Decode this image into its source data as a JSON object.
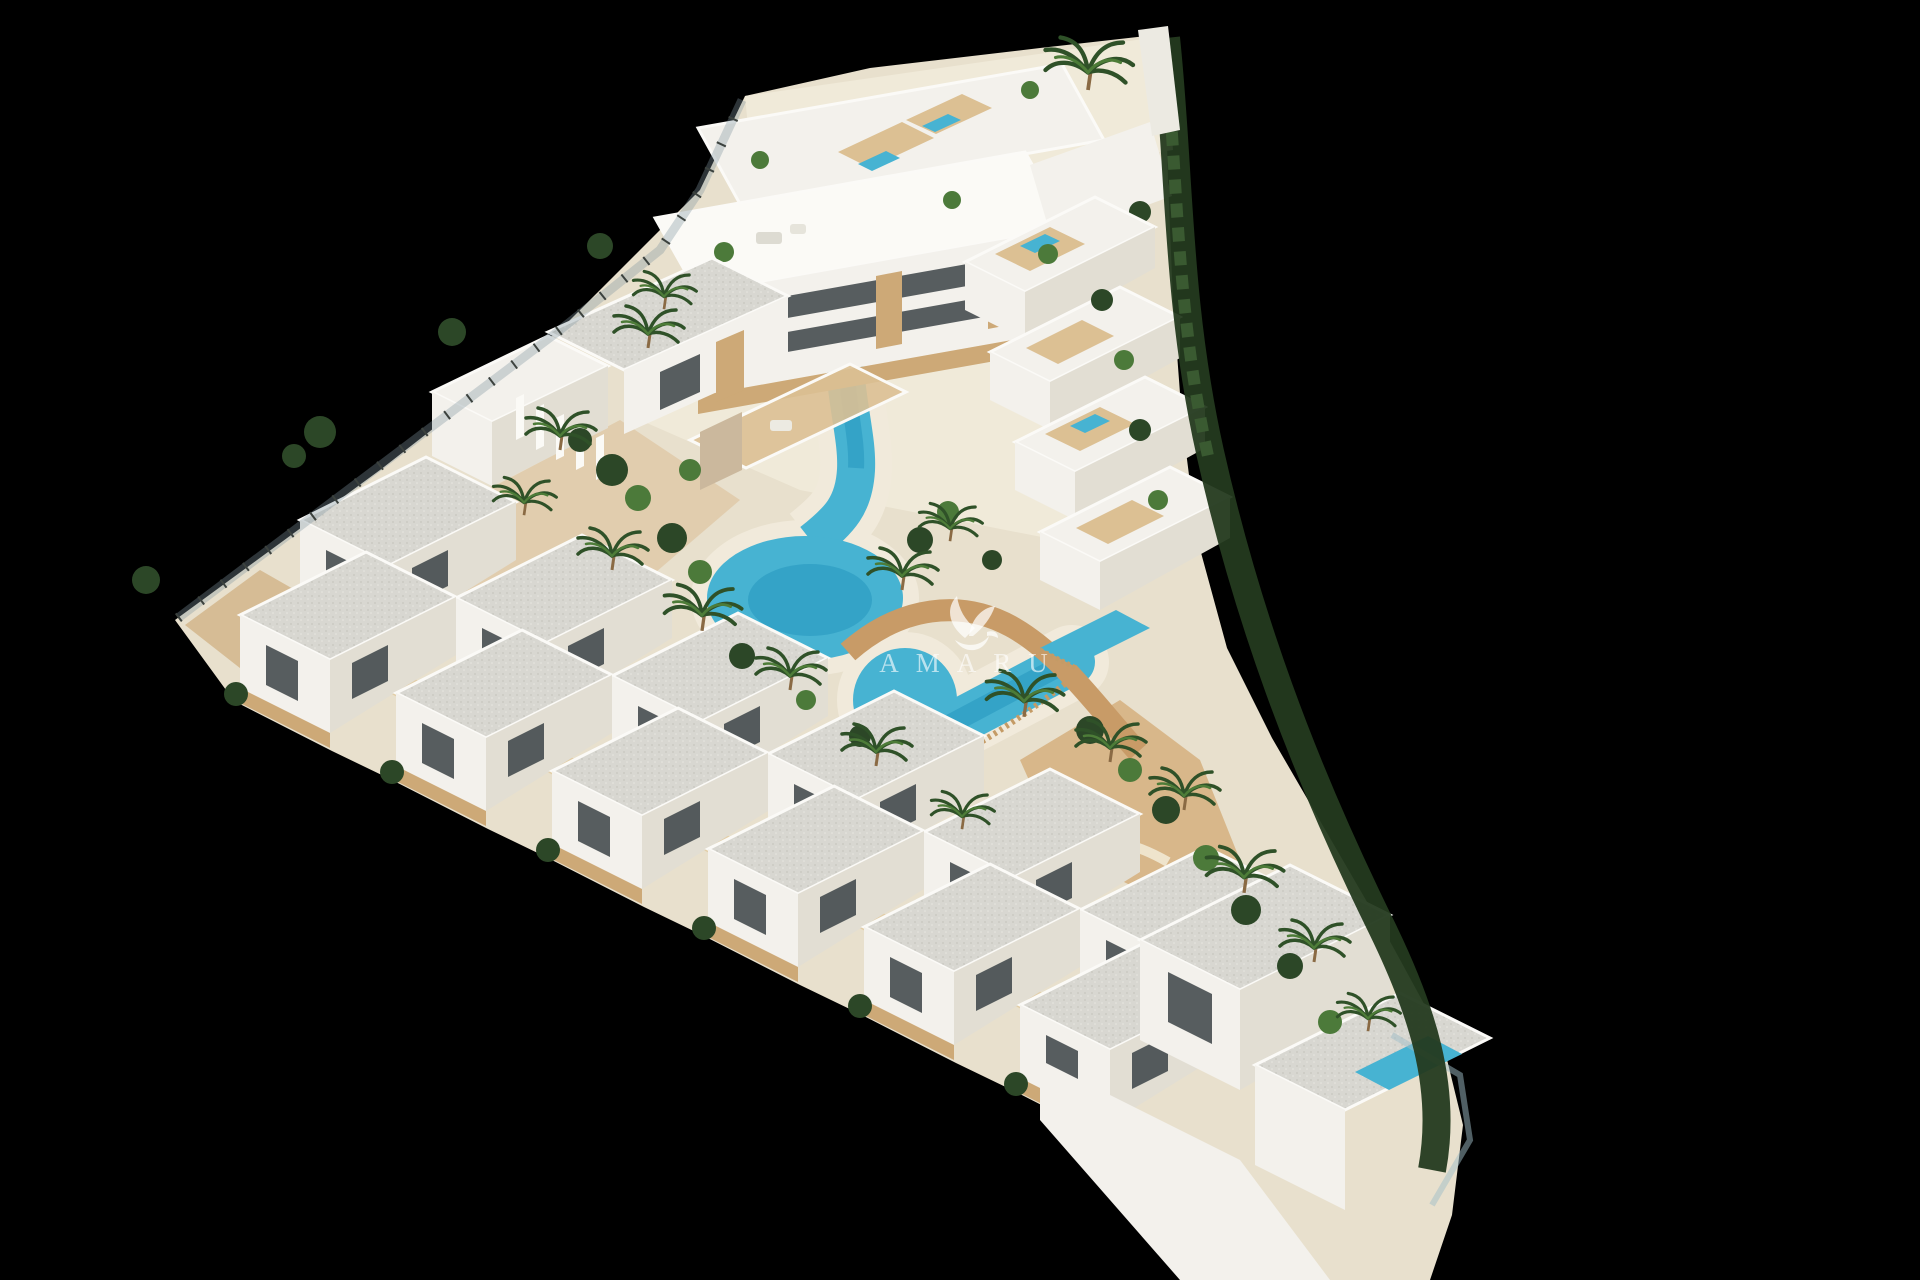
{
  "meta": {
    "scene": "aerial-3d-architectural-render",
    "background": "#000000"
  },
  "watermark": {
    "text": "AMARU",
    "icon": "hummingbird-leaf-icon"
  },
  "palette": {
    "bg": "#000000",
    "sand": "#e8e0cd",
    "sandLight": "#f0ead9",
    "beach": "#f1eadb",
    "pool": "#47b3d2",
    "poolDeep": "#2495bd",
    "bldg": "#f3f1ec",
    "bldgShade": "#e2ded3",
    "roof": "#d8d7d1",
    "roofDot": "#c7c6bf",
    "wood": "#cda977",
    "woodLight": "#dcc093",
    "glass": "#3b4347",
    "veg": "#2c4727",
    "vegLight": "#4c7a3a",
    "hedge": "#243a1f",
    "path": "#c89b67",
    "dirt": "#d6b283",
    "fence": "#3c423e"
  }
}
